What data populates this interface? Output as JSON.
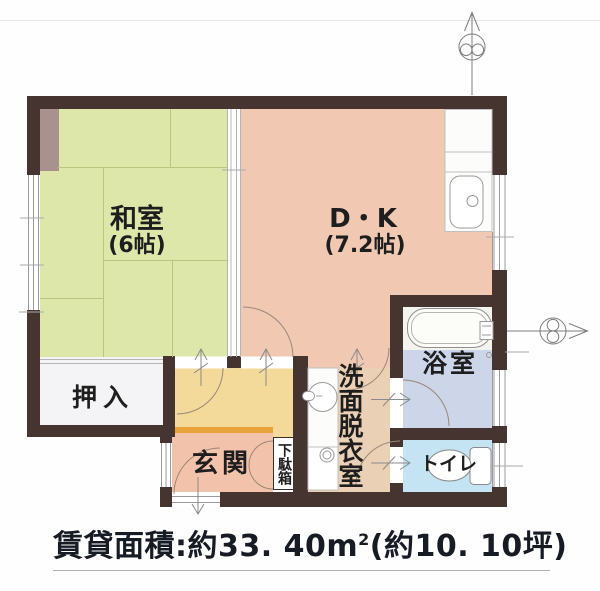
{
  "plan": {
    "rooms": {
      "washitsu": {
        "label": "和室",
        "size": "(6帖)"
      },
      "dk": {
        "label": "D・K",
        "size": "(7.2帖)"
      },
      "oshiire": {
        "label": "押入"
      },
      "genkan": {
        "label": "玄関"
      },
      "getabako": {
        "label": "下駄箱"
      },
      "senmen": {
        "label": "洗面脱衣室"
      },
      "yokushitsu": {
        "label": "浴室"
      },
      "toire": {
        "label": "トイレ"
      }
    },
    "fixtures": [
      "kitchen-sink",
      "bathtub",
      "washbasin",
      "washing-machine",
      "toilet"
    ],
    "markers": {
      "top": "section-cut-marker-up",
      "right": "section-cut-marker-right",
      "entry": "entry-arrow-down"
    }
  },
  "footer": {
    "area_label": "賃貸面積:",
    "area_value": "約33. 40",
    "area_unit_base": "m",
    "area_unit_exp": "2",
    "area_tsubo": "(約10. 10坪)",
    "full_text": "賃貸面積:約33. 40㎡(約10. 10坪)"
  },
  "colors": {
    "wall": "#453430",
    "washitsu": "#dde7a9",
    "dk": "#f1c8b2",
    "hallway": "#f3da9b",
    "step": "#e8a33b",
    "genkan": "#f2c2aa",
    "senmen": "#ead1b5",
    "bath_floor": "#cdd5e9",
    "toilet": "#c4e3f3",
    "oshiire": "#f4f4f7",
    "tokonoma": "#a9918d",
    "text": "#1e1e1e"
  }
}
